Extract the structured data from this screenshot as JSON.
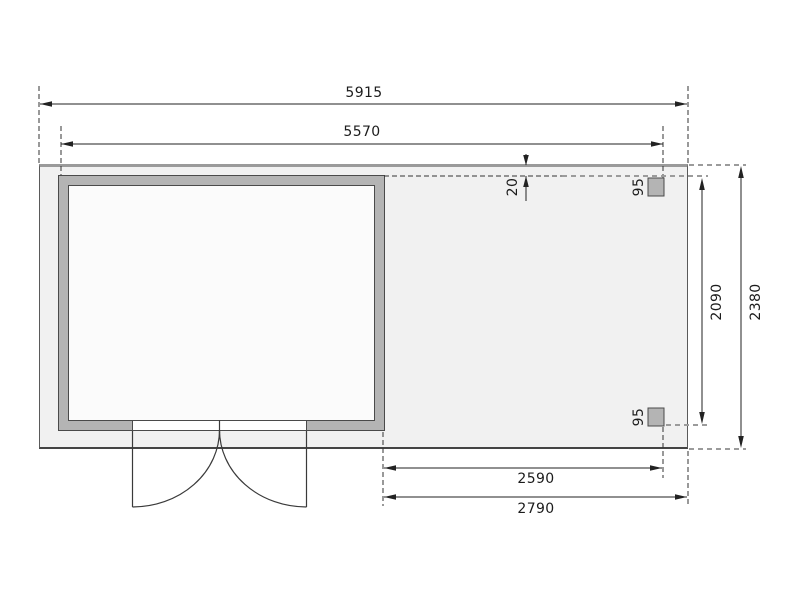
{
  "plan": {
    "type": "shed-floor-plan-with-side-roof",
    "dimension_labels": {
      "total_width": "5915",
      "house_width": "5570",
      "roof_offset": "20",
      "post_top_size": "95",
      "post_bottom_size": "95",
      "annex_inner_depth": "2090",
      "total_depth": "2380",
      "annex_inner_width": "2590",
      "annex_total_width": "2790"
    },
    "colors": {
      "base_plate_fill": "#f1f1f1",
      "wall_fill": "#b4b4b4",
      "shed_interior_fill": "#fbfbfb",
      "dimension_line": "#222222",
      "gray_reference_dash": "#9b9b9b"
    }
  }
}
